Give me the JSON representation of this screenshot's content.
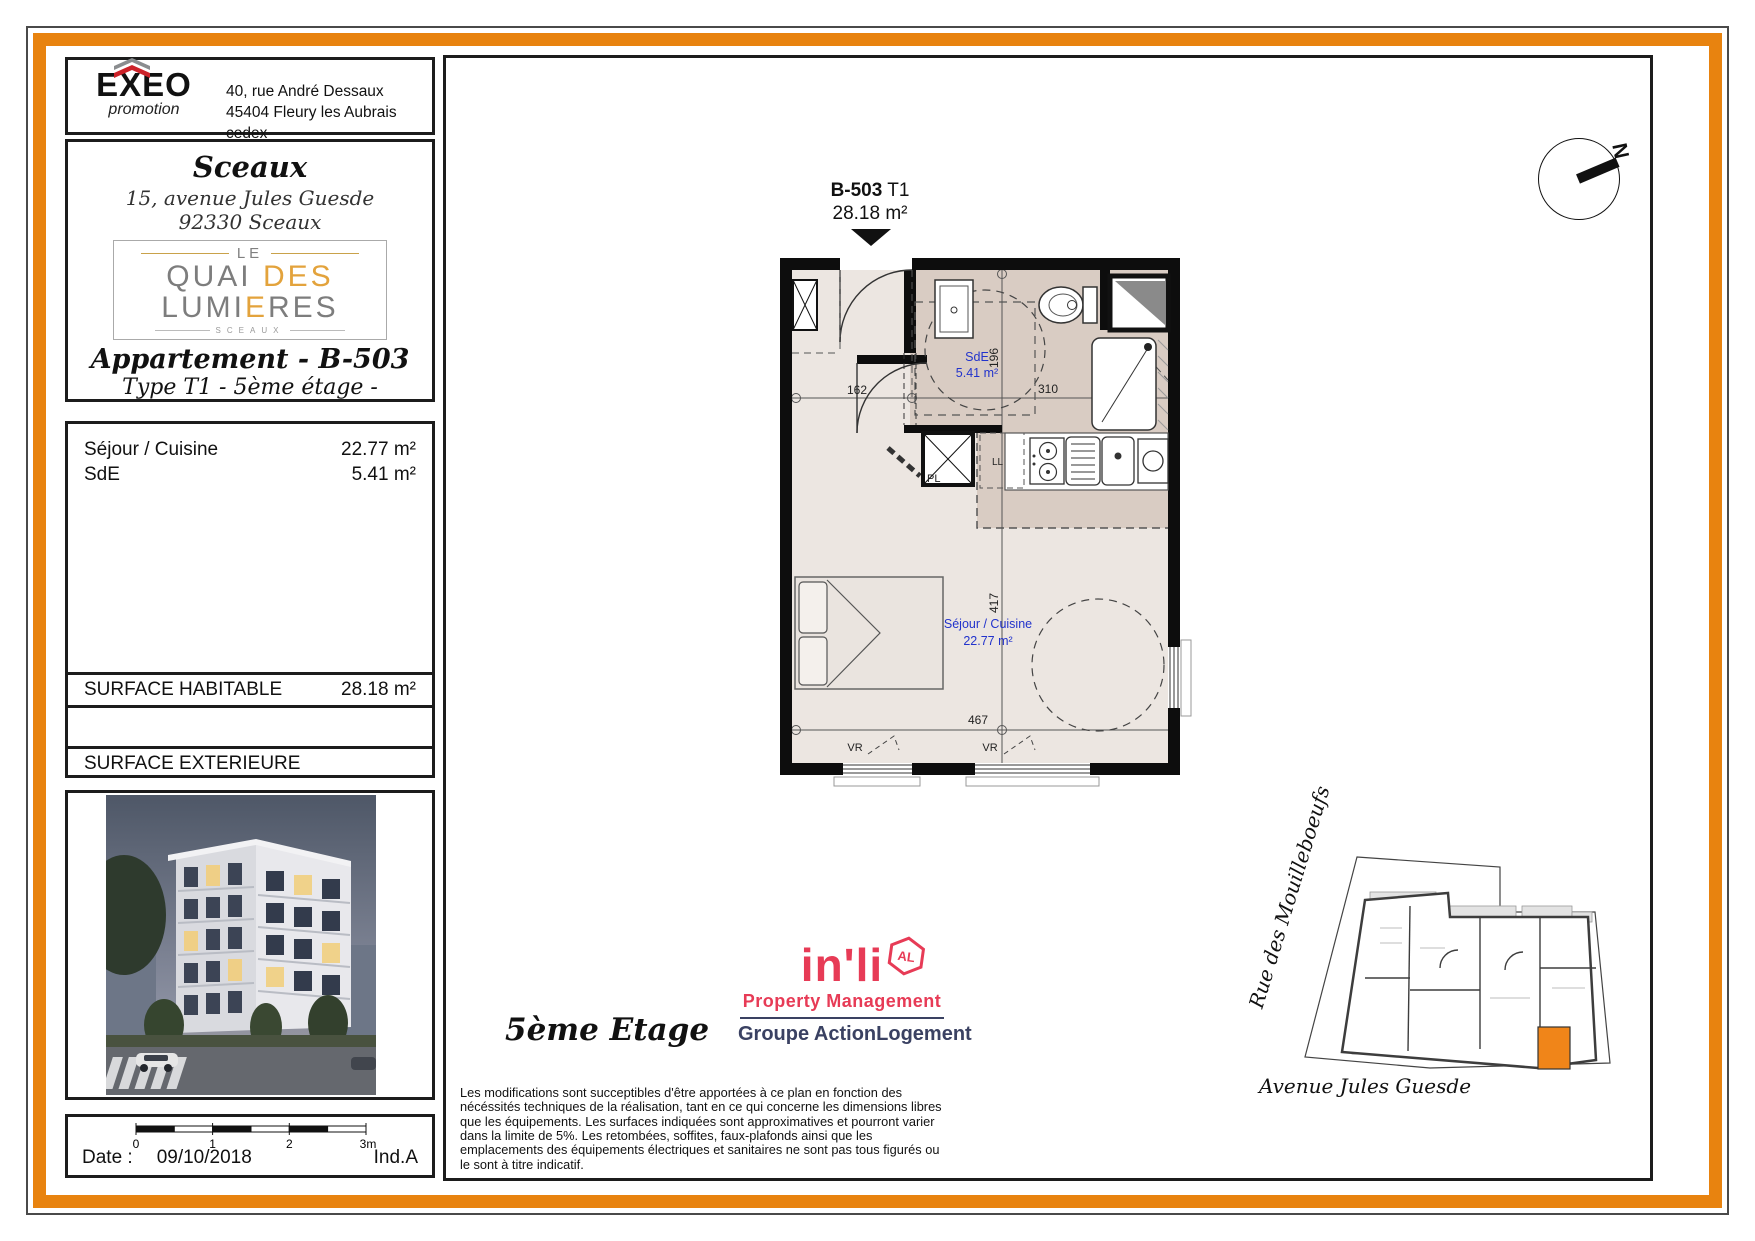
{
  "header": {
    "logo_name": "EXEO",
    "logo_sub": "promotion",
    "address_line1": "40, rue André Dessaux",
    "address_line2": "45404 Fleury les Aubrais cedex"
  },
  "property": {
    "city": "Sceaux",
    "address_line1": "15, avenue Jules Guesde",
    "address_line2": "92330 Sceaux",
    "logo": {
      "le": "LE",
      "quai": "QUAI",
      "des": "DES",
      "lumi": "LUMI",
      "e1": "E",
      "res": "RES",
      "sceaux": "SCEAUX"
    },
    "apartment_title": "Appartement - B-503",
    "apartment_subtitle": "Type T1  - 5ème étage -"
  },
  "surfaces": {
    "rows": [
      {
        "label": "Séjour / Cuisine",
        "value": "22.77 m²"
      },
      {
        "label": "SdE",
        "value": "5.41 m²"
      }
    ],
    "habitable_label": "SURFACE HABITABLE",
    "habitable_value": "28.18 m²",
    "exterieure_label": "SURFACE EXTERIEURE",
    "exterieure_value": ""
  },
  "scale_bar": {
    "tick0": "0",
    "tick1": "1",
    "tick2": "2",
    "tick3": "3m",
    "date_label": "Date :",
    "date_value": "09/10/2018",
    "index": "Ind.A"
  },
  "plan": {
    "unit": "B-503",
    "type": "T1",
    "area": "28.18 m²",
    "sde_name": "SdE",
    "sde_area": "5.41 m²",
    "sejour_name": "Séjour / Cuisine",
    "sejour_area": "22.77 m²",
    "dim_162": "162",
    "dim_310": "310",
    "dim_196": "196",
    "dim_417": "417",
    "dim_467": "467",
    "label_pl": "PL",
    "label_ll": "LL",
    "label_vr": "VR"
  },
  "compass": {
    "north": "N"
  },
  "site_plan": {
    "street_left": "Rue des Mouilleboeufs",
    "street_bottom": "Avenue Jules Guesde"
  },
  "inli": {
    "name": "in'li",
    "badge": "AL",
    "tagline": "Property Management",
    "group": "Groupe ActionLogement"
  },
  "footer": {
    "floor_label": "5ème Etage",
    "disclaimer": "Les modifications sont succeptibles d'être apportées à ce plan en fonction des nécéssités techniques de la réalisation, tant en ce qui concerne les dimensions libres que les équipements. Les surfaces indiquées sont approximatives et pourront varier dans la limite de 5%. Les retombées, soffites, faux-plafonds ainsi que les emplacements des équipements électriques et sanitaires ne sont pas tous figurés ou le sont à titre indicatif."
  },
  "colors": {
    "accent_orange": "#e8830f",
    "site_highlight": "#f08519",
    "label_blue": "#2233cc",
    "inli_red": "#e73b56",
    "inli_navy": "#3a4162"
  }
}
